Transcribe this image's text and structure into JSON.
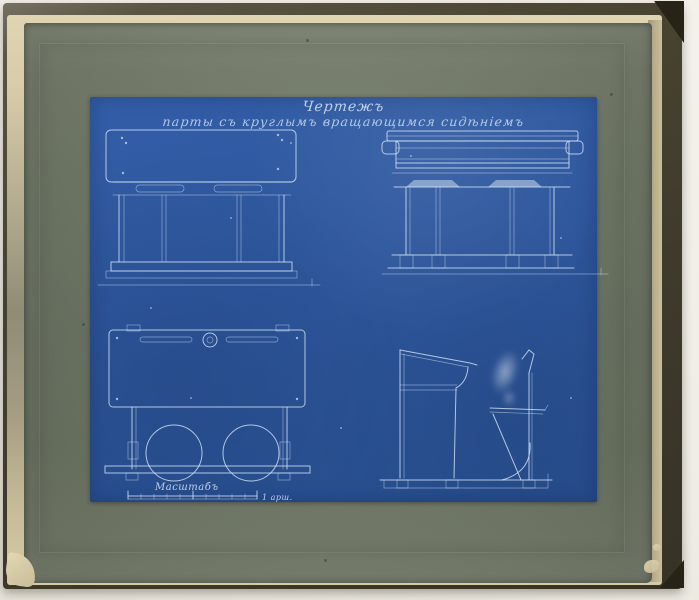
{
  "colors": {
    "backdrop": "#f1eee8",
    "cover": "#45402f",
    "edge": "#d6caa7",
    "mat": "#727b69",
    "paper": "#2d579c",
    "line": "#d6e5f7"
  },
  "blueprint": {
    "title_line1": "Чертежъ",
    "title_line2": "парты съ круглымъ вращающимся сидѣніемъ",
    "scale_label": "Масштабъ",
    "scale_unit": "1 арш.",
    "views": [
      "front-elevation",
      "rear-elevation",
      "plan-top-view",
      "side-elevation"
    ]
  }
}
